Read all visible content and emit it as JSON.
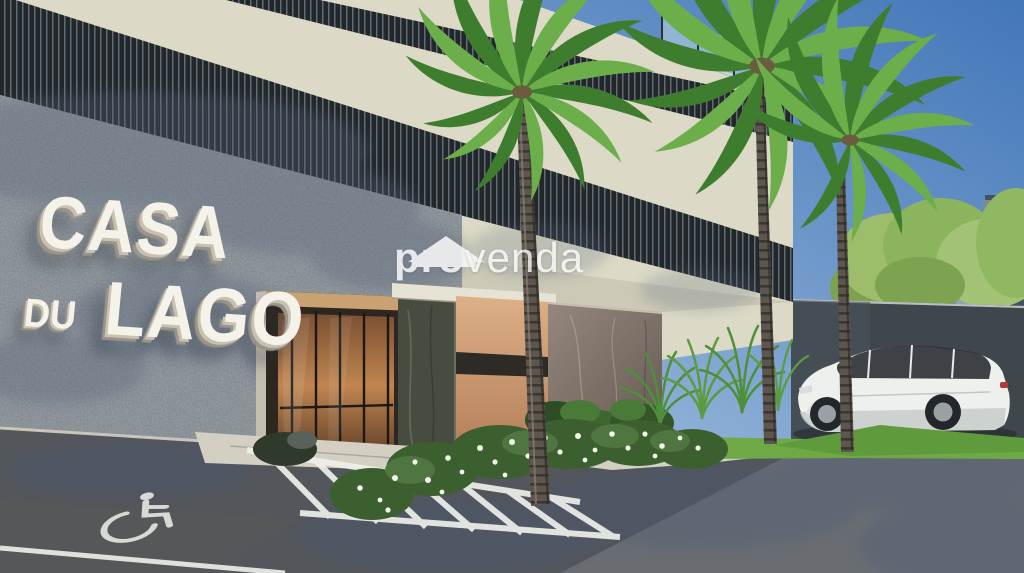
{
  "sign": {
    "line1": "CASA",
    "line2_small": "DU",
    "line2_large": "LAGO"
  },
  "watermark": {
    "brand_bold": "pro",
    "brand_light": "venda"
  },
  "colors": {
    "sky_top": "#4377b9",
    "sky_horizon": "#c9ddec",
    "facade_cream": "#dcdac6",
    "louver_dark": "#22272b",
    "louver_slat": "#79838a",
    "granite": "#9aa1a6",
    "boundary_wall": "#3f464c",
    "grass": "#6fa946",
    "asphalt": "#54575b",
    "walkway": "#d3cfc2",
    "copper": "#cf9e74",
    "copper_stripe": "#2e2a26",
    "marble": "#84766c",
    "palm_green_dark": "#3f7d2e",
    "palm_green_light": "#6cae49",
    "hedge_green": "#3c5f30",
    "flower_white": "#f2f5ea",
    "car_body": "#eef0ee",
    "tower": "#45525e",
    "trunk": "#5d564e",
    "marking_white": "#eef0ea",
    "sign_letters": "#f5f2ea",
    "watermark_white": "#ffffff",
    "wood": "#a5744a",
    "pillar": "#474c41"
  }
}
